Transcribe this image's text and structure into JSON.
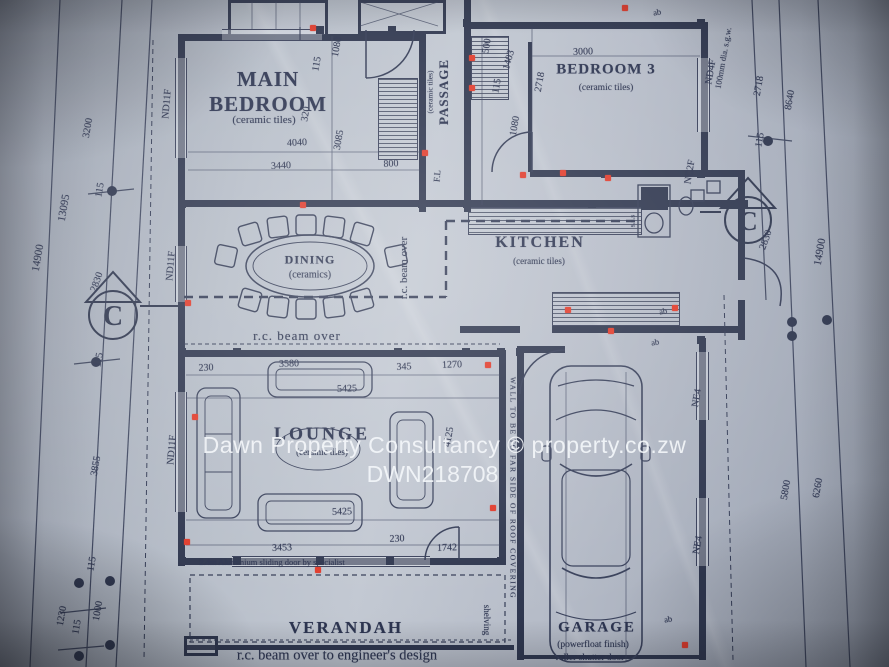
{
  "watermark": {
    "line1": "Dawn Property Consultancy  ©  property.co.zw",
    "line2": "DWN218708"
  },
  "rooms": {
    "main_bedroom": {
      "name": "MAIN BEDROOM",
      "finish": "(ceramic tiles)"
    },
    "passage": {
      "name": "PASSAGE",
      "finish": "(ceramic tiles)"
    },
    "bedroom3": {
      "name": "BEDROOM 3",
      "finish": "(ceramic tiles)"
    },
    "kitchen": {
      "name": "KITCHEN",
      "finish": "(ceramic tiles)"
    },
    "dining": {
      "name": "DINING",
      "finish": "(ceramics)"
    },
    "lounge": {
      "name": "LOUNGE",
      "finish": "(ceramic tiles)"
    },
    "verandah": {
      "name": "VERANDAH"
    },
    "garage": {
      "name": "GARAGE",
      "finish": "(powerfloat finish)",
      "door_note": "roller shutter door"
    }
  },
  "notes": {
    "beam_over_dining": "r.c. beam over",
    "beam_over_vertical": "r.c. beam over",
    "beam_engineer": "r.c. beam over to engineer's design",
    "sliding_door": "2.4m Aluminium sliding door by specialist",
    "wall_note": "WALL TO BE TO FAR SIDE OF ROOF COVERING",
    "shelving": "shelving",
    "pipe_note": "100mm dia. s.g.w.",
    "sink": "s.s.s",
    "floor_level": "F.L"
  },
  "section_marker": "C",
  "dim_labels": [
    {
      "t": "3200",
      "x": 88,
      "y": 128,
      "r": -80
    },
    {
      "t": "115",
      "x": 100,
      "y": 190,
      "r": -80
    },
    {
      "t": "13095",
      "x": 64,
      "y": 208,
      "r": -80,
      "s": 11
    },
    {
      "t": "14900",
      "x": 38,
      "y": 258,
      "r": -80,
      "s": 11
    },
    {
      "t": "2830",
      "x": 97,
      "y": 282,
      "r": -70
    },
    {
      "t": "115",
      "x": 99,
      "y": 360,
      "r": -80
    },
    {
      "t": "3855",
      "x": 96,
      "y": 466,
      "r": -80
    },
    {
      "t": "115",
      "x": 92,
      "y": 564,
      "r": -80
    },
    {
      "t": "1000",
      "x": 98,
      "y": 611,
      "r": -80
    },
    {
      "t": "1230",
      "x": 62,
      "y": 616,
      "r": -80
    },
    {
      "t": "115",
      "x": 77,
      "y": 627,
      "r": -80
    },
    {
      "t": "2718",
      "x": 759,
      "y": 86,
      "r": -80
    },
    {
      "t": "8640",
      "x": 790,
      "y": 100,
      "r": -80
    },
    {
      "t": "115",
      "x": 760,
      "y": 140,
      "r": -80
    },
    {
      "t": "2830",
      "x": 766,
      "y": 240,
      "r": -70
    },
    {
      "t": "14900",
      "x": 820,
      "y": 252,
      "r": -80,
      "s": 11
    },
    {
      "t": "5800",
      "x": 786,
      "y": 490,
      "r": -80
    },
    {
      "t": "6260",
      "x": 818,
      "y": 488,
      "r": -80
    },
    {
      "t": "115",
      "x": 317,
      "y": 64,
      "r": -80
    },
    {
      "t": "1080",
      "x": 337,
      "y": 47,
      "r": -80
    },
    {
      "t": "320",
      "x": 306,
      "y": 114,
      "r": -80
    },
    {
      "t": "3085",
      "x": 339,
      "y": 140,
      "r": -80
    },
    {
      "t": "4040",
      "x": 297,
      "y": 143,
      "r": -3
    },
    {
      "t": "3440",
      "x": 281,
      "y": 166,
      "r": -3
    },
    {
      "t": "800",
      "x": 391,
      "y": 164,
      "r": -3
    },
    {
      "t": "500",
      "x": 487,
      "y": 46,
      "r": -80
    },
    {
      "t": "1403",
      "x": 509,
      "y": 60,
      "r": -74
    },
    {
      "t": "115",
      "x": 497,
      "y": 86,
      "r": -80
    },
    {
      "t": "2718",
      "x": 540,
      "y": 82,
      "r": -80
    },
    {
      "t": "1080",
      "x": 515,
      "y": 126,
      "r": -80
    },
    {
      "t": "3000",
      "x": 583,
      "y": 52,
      "r": -2
    },
    {
      "t": "230",
      "x": 206,
      "y": 368,
      "r": -2
    },
    {
      "t": "3580",
      "x": 289,
      "y": 364,
      "r": -2
    },
    {
      "t": "345",
      "x": 404,
      "y": 367,
      "r": -2
    },
    {
      "t": "1270",
      "x": 452,
      "y": 365,
      "r": -2
    },
    {
      "t": "5425",
      "x": 347,
      "y": 389,
      "r": -2
    },
    {
      "t": "4125",
      "x": 449,
      "y": 437,
      "r": -80
    },
    {
      "t": "5425",
      "x": 342,
      "y": 512,
      "r": -2
    },
    {
      "t": "3453",
      "x": 282,
      "y": 548,
      "r": -2
    },
    {
      "t": "230",
      "x": 397,
      "y": 539,
      "r": -2
    },
    {
      "t": "1742",
      "x": 447,
      "y": 548,
      "r": -2
    }
  ],
  "wall_tags": [
    {
      "t": "ND11F",
      "x": 167,
      "y": 104,
      "r": -85
    },
    {
      "t": "ND11F",
      "x": 171,
      "y": 266,
      "r": -85
    },
    {
      "t": "ND11F",
      "x": 172,
      "y": 450,
      "r": -85
    },
    {
      "t": "ND4F",
      "x": 711,
      "y": 72,
      "r": -80
    },
    {
      "t": "NC2F",
      "x": 690,
      "y": 172,
      "r": -80
    },
    {
      "t": "NE4",
      "x": 697,
      "y": 398,
      "r": -80
    },
    {
      "t": "NE4",
      "x": 698,
      "y": 545,
      "r": -80
    }
  ],
  "tiny_labels": [
    {
      "t": "ab",
      "x": 657,
      "y": 12,
      "r": -10
    },
    {
      "t": "ab",
      "x": 663,
      "y": 311,
      "r": -10
    },
    {
      "t": "ab",
      "x": 655,
      "y": 342,
      "r": -10
    },
    {
      "t": "ab",
      "x": 668,
      "y": 619,
      "r": -10
    }
  ],
  "red_dots": [
    [
      313,
      28
    ],
    [
      472,
      58
    ],
    [
      625,
      8
    ],
    [
      472,
      88
    ],
    [
      425,
      153
    ],
    [
      523,
      175
    ],
    [
      563,
      173
    ],
    [
      608,
      178
    ],
    [
      303,
      205
    ],
    [
      188,
      303
    ],
    [
      568,
      310
    ],
    [
      611,
      331
    ],
    [
      675,
      308
    ],
    [
      488,
      365
    ],
    [
      195,
      417
    ],
    [
      493,
      508
    ],
    [
      187,
      542
    ],
    [
      318,
      570
    ],
    [
      685,
      645
    ]
  ],
  "colors": {
    "ink": "#2e364e",
    "red": "#e03a2a",
    "paper": "#b6bdc8",
    "watermark": "#f2f5f9"
  }
}
